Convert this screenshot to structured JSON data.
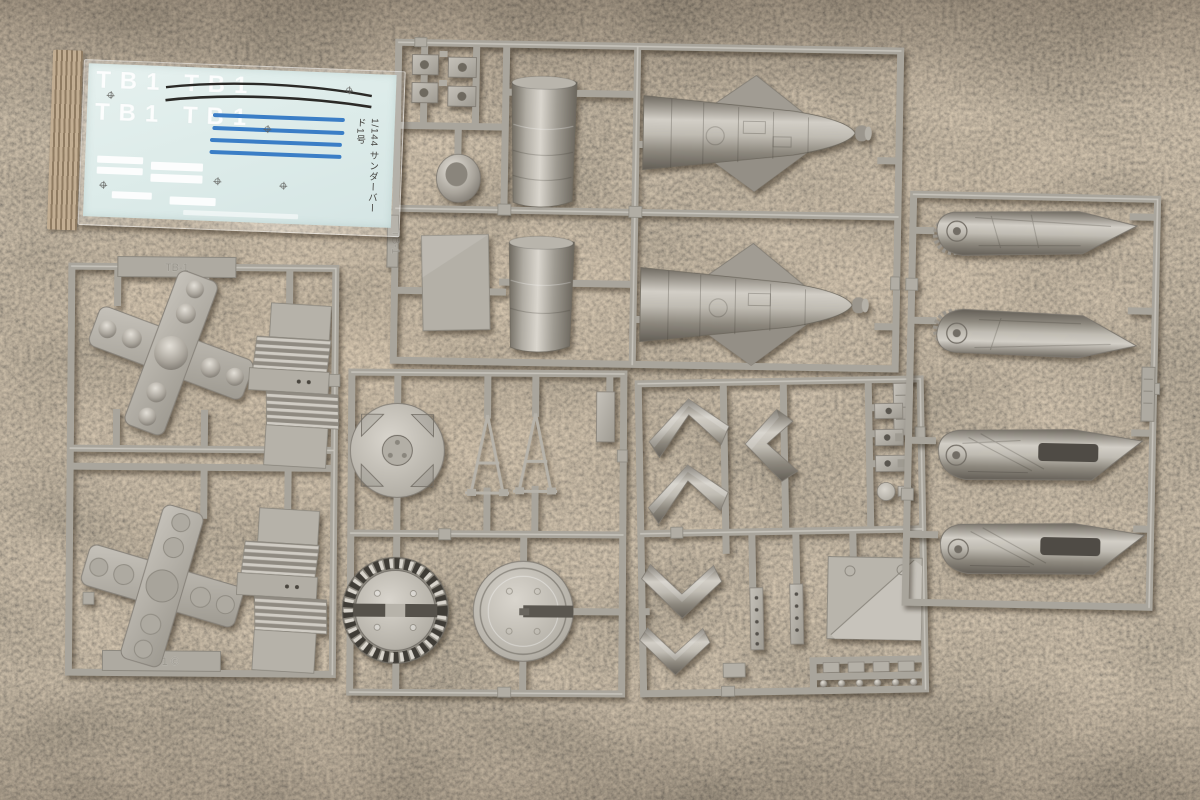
{
  "scene": {
    "title": "1/144 Thunderbird 1 plastic model kit sprues photographed on brown carpet",
    "background": "brown cut-pile carpet with woven edge tape at upper left"
  },
  "decal_sheet": {
    "tb1_row_1": "TB1 TB1",
    "tb1_row_2": "TB1 TB1",
    "vertical_caption": "1/144 サンダーバード1号",
    "colors": {
      "paper": "#dcebe9",
      "blue_stripe": "#3b7ec6",
      "black_stripe": "#2b2a27",
      "white_marking": "#ffffff"
    }
  },
  "sprues": {
    "plastic_color": "#aba79e",
    "top": {
      "molded_tag": "TB-1",
      "parts": "fuselage halves with delta wings x2, body cylinders x2, hatch panel, nose cone, clamp fittings x4"
    },
    "left": {
      "top_tag": "TB-1",
      "bottom_tag": "TB-1 ©",
      "parts": "domed thruster cross plates x2, ribbed exhaust blocks x2"
    },
    "middle": {
      "parts": "bulkhead disc, landing-leg triangle frames x2, notched nozzle ring, slotted base disc"
    },
    "chevron": {
      "parts": "chevron fins x4, angled fin, riveted strips x2, creased hatch ramp, small fittings"
    },
    "right": {
      "parts": "swing wings x4 (two with gear-tooth pivots, two with slots)"
    }
  },
  "carpet_colors": {
    "base": "#8a7963",
    "dark": "#5c4e3e",
    "light": "#a8957c"
  }
}
